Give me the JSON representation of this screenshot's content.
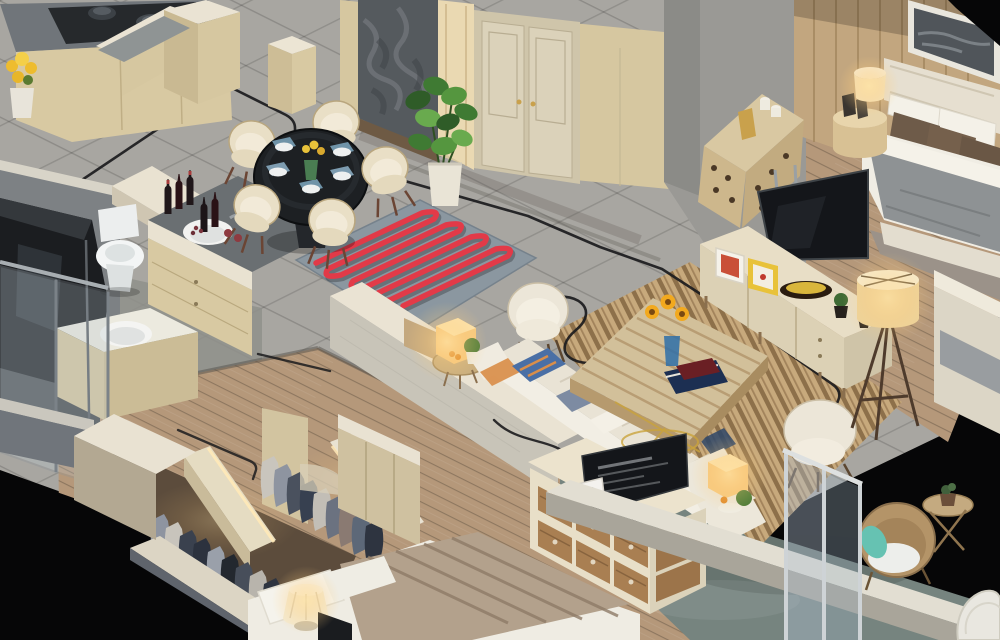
{
  "scene": {
    "type": "3d-isometric-apartment-cutaway-render",
    "rooms": [
      {
        "name": "kitchen",
        "objects": [
          "gas-cooktop-with-pots",
          "gray-stone-counter",
          "beige-cabinets",
          "u-shaped-island",
          "black-oven-column",
          "yellow-flowers"
        ]
      },
      {
        "name": "entry-hall",
        "objects": [
          "dark-stone-accent-wall",
          "cream-double-door",
          "monstera-plant",
          "marble-floor-inlay"
        ]
      },
      {
        "name": "dining-area",
        "objects": [
          "round-dark-glass-table",
          "five-cream-tub-chairs",
          "blue-place-settings",
          "wine-bottles-on-ledge",
          "red-coil-rug"
        ]
      },
      {
        "name": "bathroom",
        "objects": [
          "toilet",
          "vanity-sink",
          "second-vanity-sink",
          "glass-shower-enclosure"
        ]
      },
      {
        "name": "living-room",
        "objects": [
          "l-shaped-white-sofa",
          "patterned-cushions",
          "glowing-cube-lamps",
          "round-side-table",
          "slatted-coffee-table",
          "sunflower-vase",
          "books",
          "striped-area-rug",
          "two-cream-armchairs",
          "tv-on-console",
          "media-console",
          "picture-frames",
          "decorative-bowl",
          "tripod-floor-lamp"
        ]
      },
      {
        "name": "master-bedroom",
        "objects": [
          "panorama-artwork",
          "upholstered-headboard",
          "white-and-brown-pillows",
          "gray-duvet-bed",
          "drum-nightstand",
          "glowing-table-lamp",
          "perforated-dresser",
          "candles-and-book"
        ]
      },
      {
        "name": "walk-in-closet",
        "objects": [
          "two-rows-hanging-clothes",
          "lit-wardrobe-rails",
          "beige-divider-walls"
        ]
      },
      {
        "name": "second-bedroom",
        "objects": [
          "bed-with-striped-throw",
          "pleated-glowing-lamp",
          "drawer-dresser",
          "tv-with-menu-screen",
          "photo-frame"
        ]
      },
      {
        "name": "balcony",
        "objects": [
          "rattan-armchair",
          "teal-cushion",
          "rattan-side-table",
          "succulent-pot",
          "white-parapet",
          "glass-railing",
          "corner-wicker-chair"
        ]
      }
    ],
    "details": [
      "black-smart-cable-routing-lines-on-floors",
      "warm-glowing-lamps",
      "gray-marble-tile-floor",
      "wood-plank-floor",
      "black-void-background"
    ]
  },
  "palette": {
    "void_black": "#060607",
    "marble_floor": "#a8a6a1",
    "bath_floor": "#8f908b",
    "wood_floor": "#b5987a",
    "balcony_floor": "#76847f",
    "wall_beige": "#d6c7a0",
    "wall_top_white": "#eae3d3",
    "wall_gray": "#9a9995",
    "stone_panel": "#555a5e",
    "lit_pillar": "#ead9b2",
    "door_cream": "#dbd2ba",
    "counter_gray": "#70757a",
    "appliance_black": "#1b1d20",
    "cabinet_beige": "#d8c9a2",
    "rug_base": "#8b97a0",
    "rug_coil_red": "#e23a48",
    "stripe_rug_base": "#c7a97c",
    "stripe_rug_dark": "#8a6c48",
    "sofa_white": "#f2eee4",
    "furniture_wood": "#d2c09a",
    "drawer_wood": "#a97f52",
    "tv_black": "#14161a",
    "glass_blue": "#aebfcf",
    "lamp_glow": "#ffd98a",
    "plant_green": "#3f7a33",
    "duvet_gray": "#8e9294",
    "pillow_brown": "#6e5b49",
    "teal_cushion": "#66c2b2",
    "cable_black": "#1b1b1d",
    "sunflower_yellow": "#f2a91e",
    "cream_chair": "#e9dfc6",
    "rattan_tan": "#b49468",
    "wine_bottle": "#20171a"
  }
}
